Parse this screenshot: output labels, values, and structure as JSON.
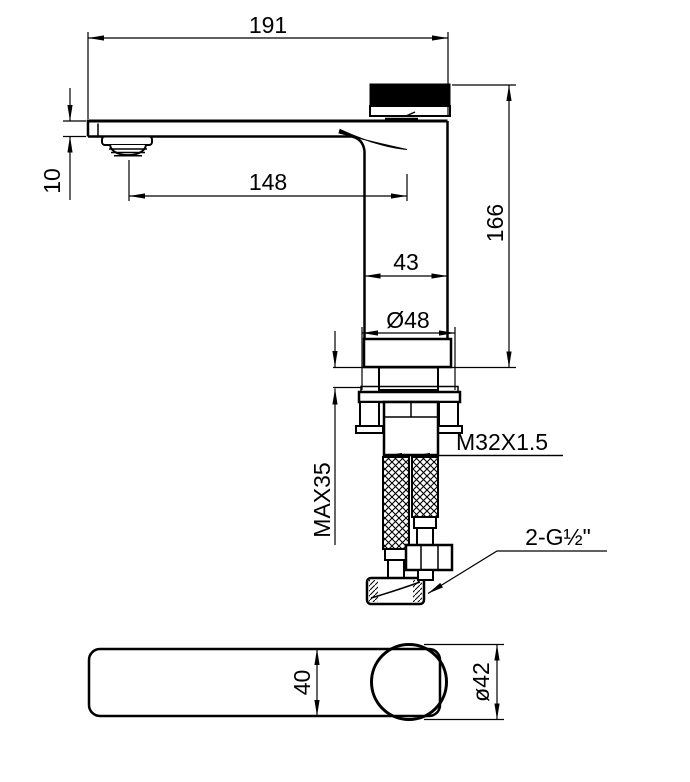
{
  "drawing": {
    "side_view": {
      "overall_length": "191",
      "spout_thickness": "10",
      "spout_reach": "148",
      "overall_height": "166",
      "body_width": "43",
      "base_diameter": "Ø48",
      "max_mounting_thickness": "MAX35",
      "shank_thread": "M32X1.5",
      "hose_connection": "2-G½\""
    },
    "top_view": {
      "spout_width": "40",
      "knob_diameter": "ø42"
    },
    "colors": {
      "line": "#000000",
      "background": "#ffffff"
    }
  }
}
